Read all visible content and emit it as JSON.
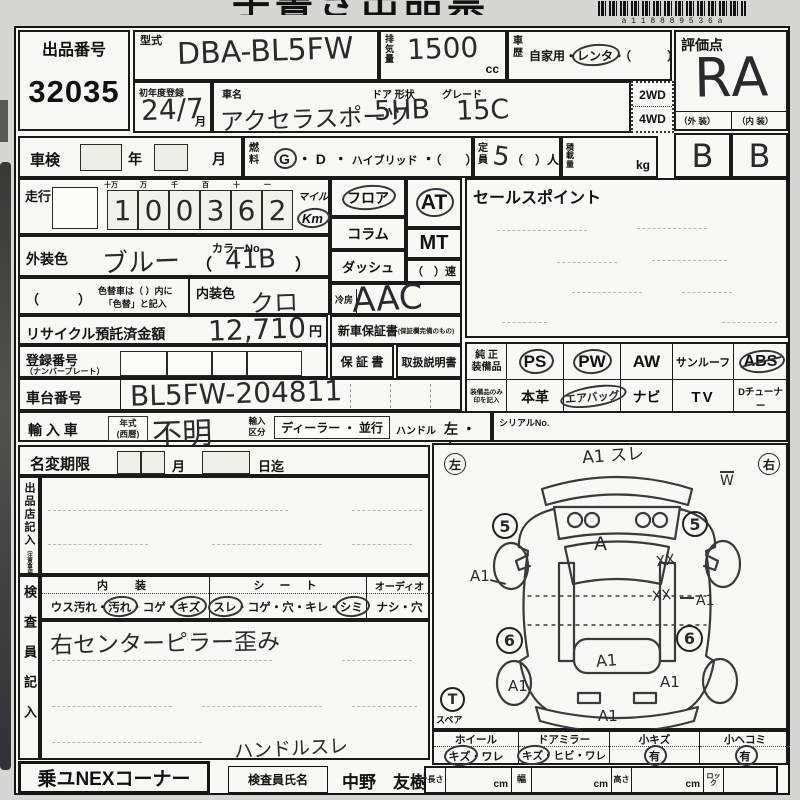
{
  "page": {
    "clipped_title": "手書き出品票",
    "barcode_digits": "a 1 1 8 8 8 9 5 3 6 a",
    "sep": "・"
  },
  "header": {
    "auction_no_label": "出品番号",
    "auction_no": "32035",
    "model_label": "型式",
    "model_value": "DBA-BL5FW",
    "displacement_label": "排気量",
    "displacement_value": "1500",
    "displacement_unit": "cc",
    "history_label": "車歴",
    "history_private": "自家用",
    "history_rental": "レンタ",
    "history_other": "（　　　）",
    "grade_label": "評価点",
    "grade_value": "RA",
    "exterior_label": "（外 装）",
    "interior_label": "（内 装）",
    "exterior_grade": "B",
    "interior_grade": "B",
    "first_reg_label": "初年度登録",
    "first_reg_value": "24/7",
    "month_unit": "月",
    "car_name_label": "車名",
    "door_shape_label": "ドア 形状",
    "grade_name_label": "グレード",
    "car_name_value": "アクセラスポーツ",
    "door_shape_value": "5HB",
    "trim_value": "15C",
    "drive_2wd": "2WD",
    "drive_4wd": "4WD"
  },
  "row2": {
    "shaken_label": "車検",
    "year_label": "年",
    "month_label": "月",
    "fuel_label": "燃料",
    "fuel_g": "G",
    "fuel_d": "D",
    "fuel_hybrid": "ハイブリッド",
    "fuel_other": "（　　）",
    "capacity_label": "定員",
    "capacity_value": "5",
    "capacity_suffix": "（　）人",
    "load_label": "積載量",
    "load_unit": "kg"
  },
  "odometer": {
    "label": "走行",
    "digit_headers": [
      "十万",
      "万",
      "千",
      "百",
      "十",
      "一"
    ],
    "digits": [
      "1",
      "0",
      "0",
      "3",
      "6",
      "2"
    ],
    "comma": ",",
    "mile_label": "マイル",
    "km_label": "Km"
  },
  "colors": {
    "exterior_label": "外装色",
    "exterior_value": "ブルー",
    "color_no_label": "カラーNo.",
    "paren_open": "（",
    "color_no_value": "41B",
    "paren_close": "）",
    "color_change_paren": "（　　　）",
    "color_change_note1": "色替車は（ ）内に",
    "color_change_note2": "「色替」と記入",
    "interior_label": "内装色",
    "interior_value": "クロ"
  },
  "transmission": {
    "floor": "フロア",
    "column": "コラム",
    "dash": "ダッシュ",
    "at": "AT",
    "mt": "MT",
    "speed": "（　）速",
    "ac_label": "冷房",
    "ac_value": "AAC"
  },
  "sales_point": {
    "label": "セールスポイント"
  },
  "recycle": {
    "label": "リサイクル預託済金額",
    "amount": "12,710",
    "unit": "円"
  },
  "warranty": {
    "new_car": "新車保証書",
    "new_car_note": "(保証欄完備のもの)",
    "book": "保 証 書",
    "manual": "取扱説明書"
  },
  "registration": {
    "label": "登録番号",
    "sublabel": "（ナンバープレート）"
  },
  "chassis": {
    "label": "車台番号",
    "value": "BL5FW-204811"
  },
  "equipment": {
    "label1": "純 正",
    "label2": "装備品",
    "note1": "装備品のみ",
    "note2": "印を記入",
    "ps": "PS",
    "pw": "PW",
    "aw": "AW",
    "sunroof": "サンルーフ",
    "abs": "ABS",
    "leather": "本革",
    "airbag": "エアバッグ",
    "navi": "ナビ",
    "tv": "TV",
    "dtuner": "Dチューナー",
    "dtuner_note": "(純正・社外含む)"
  },
  "import": {
    "label": "輸 入 車",
    "year_label1": "年式",
    "year_label2": "(西暦)",
    "year_value": "不明",
    "kubun1": "輸入",
    "kubun2": "区分",
    "dealer": "ディーラー ・ 並行",
    "handle_label": "ハンドル",
    "handle_options": "左 ・ 右",
    "serial_label": "シリアルNo."
  },
  "rename": {
    "label": "名変期限",
    "month": "月",
    "day_until": "日迄"
  },
  "seller": {
    "vertical_label": "出品店記入",
    "vertical_note": "（注意事項）"
  },
  "inspector": {
    "vertical_label": "検査員記入",
    "interior_header": "内　装",
    "int_opt1": "ウス汚れ",
    "int_opt2": "汚れ",
    "int_opt3": "コゲ",
    "int_opt4": "キズ",
    "seat_header": "シ ー ト",
    "seat_opt1": "スレ",
    "seat_opt2": "コゲ",
    "seat_opt3": "穴",
    "seat_opt4": "キレ",
    "seat_opt5": "シミ",
    "audio_header": "オーディオ",
    "audio_opt1": "ナシ",
    "audio_opt2": "穴",
    "note1": "右センターピラー歪み",
    "note2": "ハンドルスレ"
  },
  "diagram": {
    "left_badge": "左",
    "right_badge": "右",
    "ann_front": "A1 スレ",
    "ann_w": "W",
    "wheel_fl": "5",
    "wheel_fr": "5",
    "ann_hood": "A",
    "ann_left_side": "A1",
    "ann_xx1": "XX",
    "ann_xx2": "XX",
    "ann_right_side": "A1",
    "wheel_rl": "6",
    "wheel_rr": "6",
    "ann_center": "A1",
    "ann_rear_left": "A1",
    "ann_rear_right": "A1",
    "ann_rear_bumper": "A1",
    "spare_badge": "T",
    "spare_label": "スペア"
  },
  "condition": {
    "wheel_label": "ホイール",
    "wheel_opt1": "キズ",
    "wheel_opt2": "ワレ",
    "mirror_label": "ドアミラー",
    "mirror_opt1": "キズ",
    "mirror_opt2": "ヒビ",
    "mirror_opt3": "ワレ",
    "scratch_label": "小キズ",
    "scratch_value": "有",
    "dent_label": "小ヘコミ",
    "dent_value": "有"
  },
  "dimensions": {
    "length_label": "長さ",
    "width_label": "幅",
    "height_label": "高さ",
    "cm": "cm",
    "lock_label": "ロック"
  },
  "footer": {
    "corner_label": "乗ユNEXコーナー",
    "inspector_name_label": "検査員氏名",
    "inspector_name": "中野　友樹"
  },
  "selections": {
    "history_rental_circled": true,
    "fuel_g_circled": true,
    "km_circled": true,
    "floor_circled": true,
    "at_circled": true,
    "ps_circled": true,
    "pw_circled": true,
    "abs_marked": true,
    "airbag_circled": true,
    "int_dirt_circled": true,
    "int_kizu_circled": true,
    "seat_sure_circled": true,
    "seat_shimi_circled": true,
    "wheel_kizu_circled": true,
    "mirror_kizu_circled": true,
    "scratch_yes_circled": true,
    "dent_yes_circled": true
  }
}
